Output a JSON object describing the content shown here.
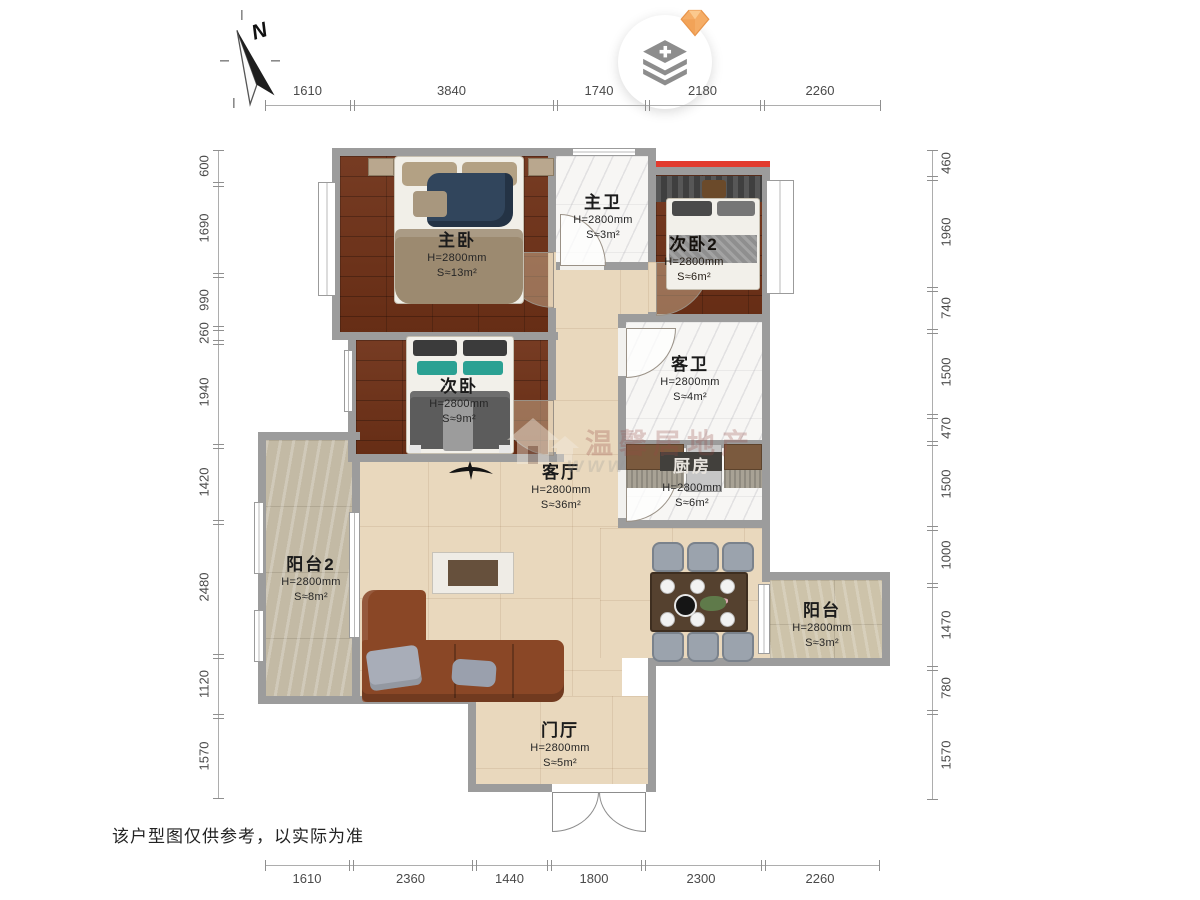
{
  "compass": {
    "label": "N"
  },
  "toolbar": {
    "layers_button": {
      "icon": "layers-plus-icon",
      "badge_icon": "gem-icon"
    }
  },
  "dims": {
    "top": [
      "1610",
      "3840",
      "1740",
      "2180",
      "2260"
    ],
    "bottom": [
      "1610",
      "2360",
      "1440",
      "1800",
      "2300",
      "2260"
    ],
    "left": [
      "600",
      "1690",
      "990",
      "260",
      "1940",
      "1420",
      "2480",
      "1120",
      "1570"
    ],
    "right": [
      "460",
      "1960",
      "740",
      "1500",
      "470",
      "1500",
      "1000",
      "1470",
      "780",
      "1570"
    ]
  },
  "rooms": {
    "master_bedroom": {
      "name": "主卧",
      "height": "H=2800mm",
      "area": "S≈13m²"
    },
    "master_bath": {
      "name": "主卫",
      "height": "H=2800mm",
      "area": "S≈3m²"
    },
    "bedroom2": {
      "name": "次卧2",
      "height": "H=2800mm",
      "area": "S≈6m²"
    },
    "bedroom": {
      "name": "次卧",
      "height": "H=2800mm",
      "area": "S≈9m²"
    },
    "guest_bath": {
      "name": "客卫",
      "height": "H=2800mm",
      "area": "S≈4m²"
    },
    "kitchen": {
      "name": "厨房",
      "height": "H=2800mm",
      "area": "S≈6m²"
    },
    "living": {
      "name": "客厅",
      "height": "H=2800mm",
      "area": "S≈36m²"
    },
    "balcony2": {
      "name": "阳台2",
      "height": "H=2800mm",
      "area": "S≈8m²"
    },
    "balcony": {
      "name": "阳台",
      "height": "H=2800mm",
      "area": "S≈3m²"
    },
    "foyer": {
      "name": "门厅",
      "height": "H=2800mm",
      "area": "S≈5m²"
    }
  },
  "watermark": {
    "logo_text": "温馨居地产",
    "url_text": "www"
  },
  "disclaimer": "该户型图仅供参考，以实际为准",
  "colors": {
    "wall": "#9c9c9c",
    "wood_floor": "#6f3117",
    "tile_floor": "#e9d8bd",
    "stone_floor": "#c3baa5",
    "marble_floor": "#f7f6f4",
    "accent_red": "#e23b2e",
    "gem": "#f2a35c"
  }
}
